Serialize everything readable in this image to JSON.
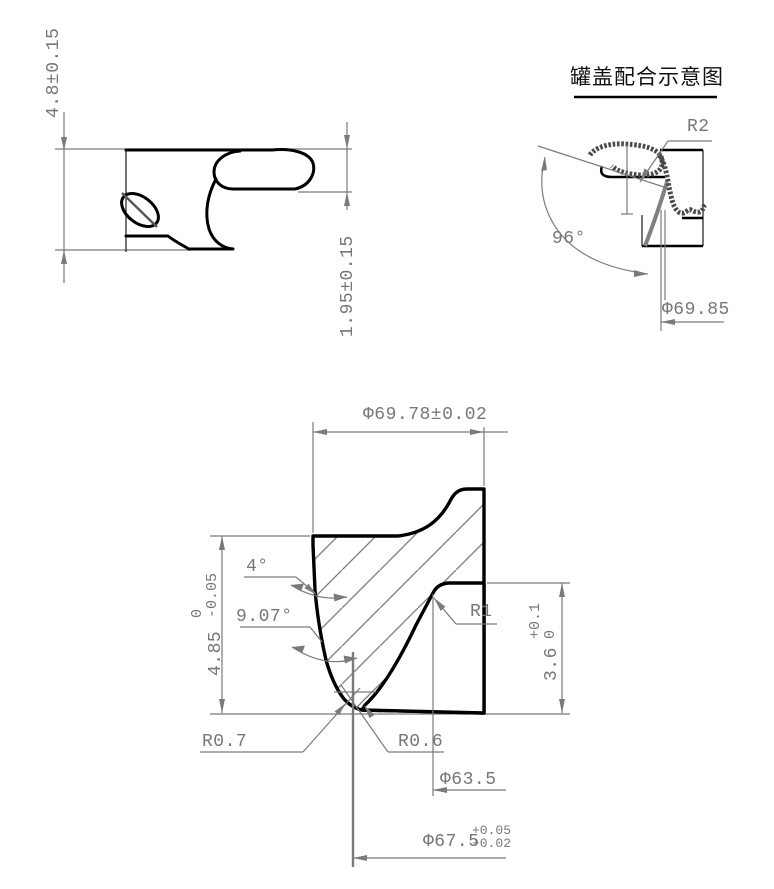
{
  "title": "罐盖配合示意图",
  "colors": {
    "background": "#ffffff",
    "profile_line": "#000000",
    "dimension_line": "#7a7a7a",
    "lid_section": "#4a4a4a"
  },
  "lid_profile_view": {
    "height_dim": "4.8±0.15",
    "curl_height_dim": "1.95±0.15"
  },
  "fit_view": {
    "radius_label": "R2",
    "angle_label": "96°",
    "diameter_label": "Φ69.85"
  },
  "die_view": {
    "top_diameter": "Φ69.78±0.02",
    "angle_top": "4°",
    "angle_bottom": "9.07°",
    "height_left": {
      "main": "4.85",
      "tol_upper": "0",
      "tol_lower": "-0.05"
    },
    "radius_r1": "R1",
    "height_right": {
      "main": "3.6",
      "tol_upper": "+0.1",
      "tol_lower": "0"
    },
    "radius_left": "R0.7",
    "radius_right": "R0.6",
    "inner_diameter": "Φ63.5",
    "groove_diameter": {
      "main": "Φ67.5",
      "tol_upper": "+0.05",
      "tol_lower": "+0.02"
    }
  }
}
